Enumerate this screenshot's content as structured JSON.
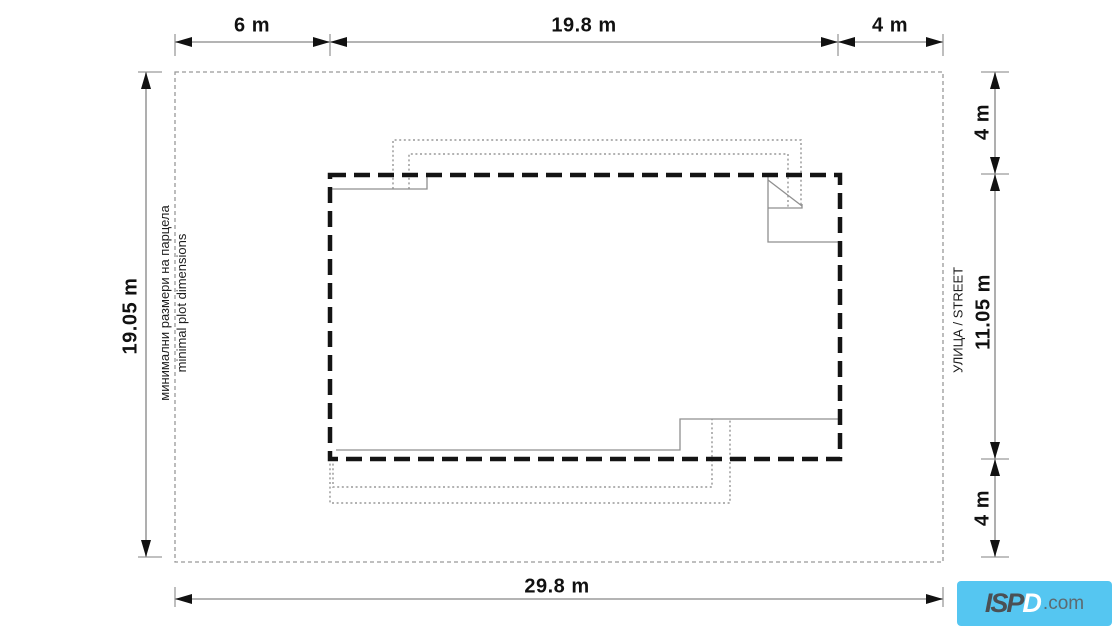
{
  "dimensions": {
    "top": [
      "6 m",
      "19.8 m",
      "4 m"
    ],
    "left": "19.05 m",
    "right_top": "4 m",
    "right_middle": "11.05 m",
    "right_bottom": "4 m",
    "bottom": "29.8 m"
  },
  "annotations": {
    "plot_note_line1": "минимални размери на парцела",
    "plot_note_line2": "minimal plot dimensions",
    "street": "УЛИЦА / STREET"
  },
  "logo": {
    "part_dark": "ISP",
    "part_light": "D",
    "domain": ".com",
    "background": "#55c6f1"
  },
  "colors": {
    "dimension_line": "#9b9b9b",
    "arrow": "#111111",
    "plot_boundary": "#999999",
    "building_envelope": "#141414",
    "building_outline": "#8f8f8f",
    "roof_outline": "#a8a8a8",
    "text": "#111111",
    "background": "#ffffff"
  }
}
